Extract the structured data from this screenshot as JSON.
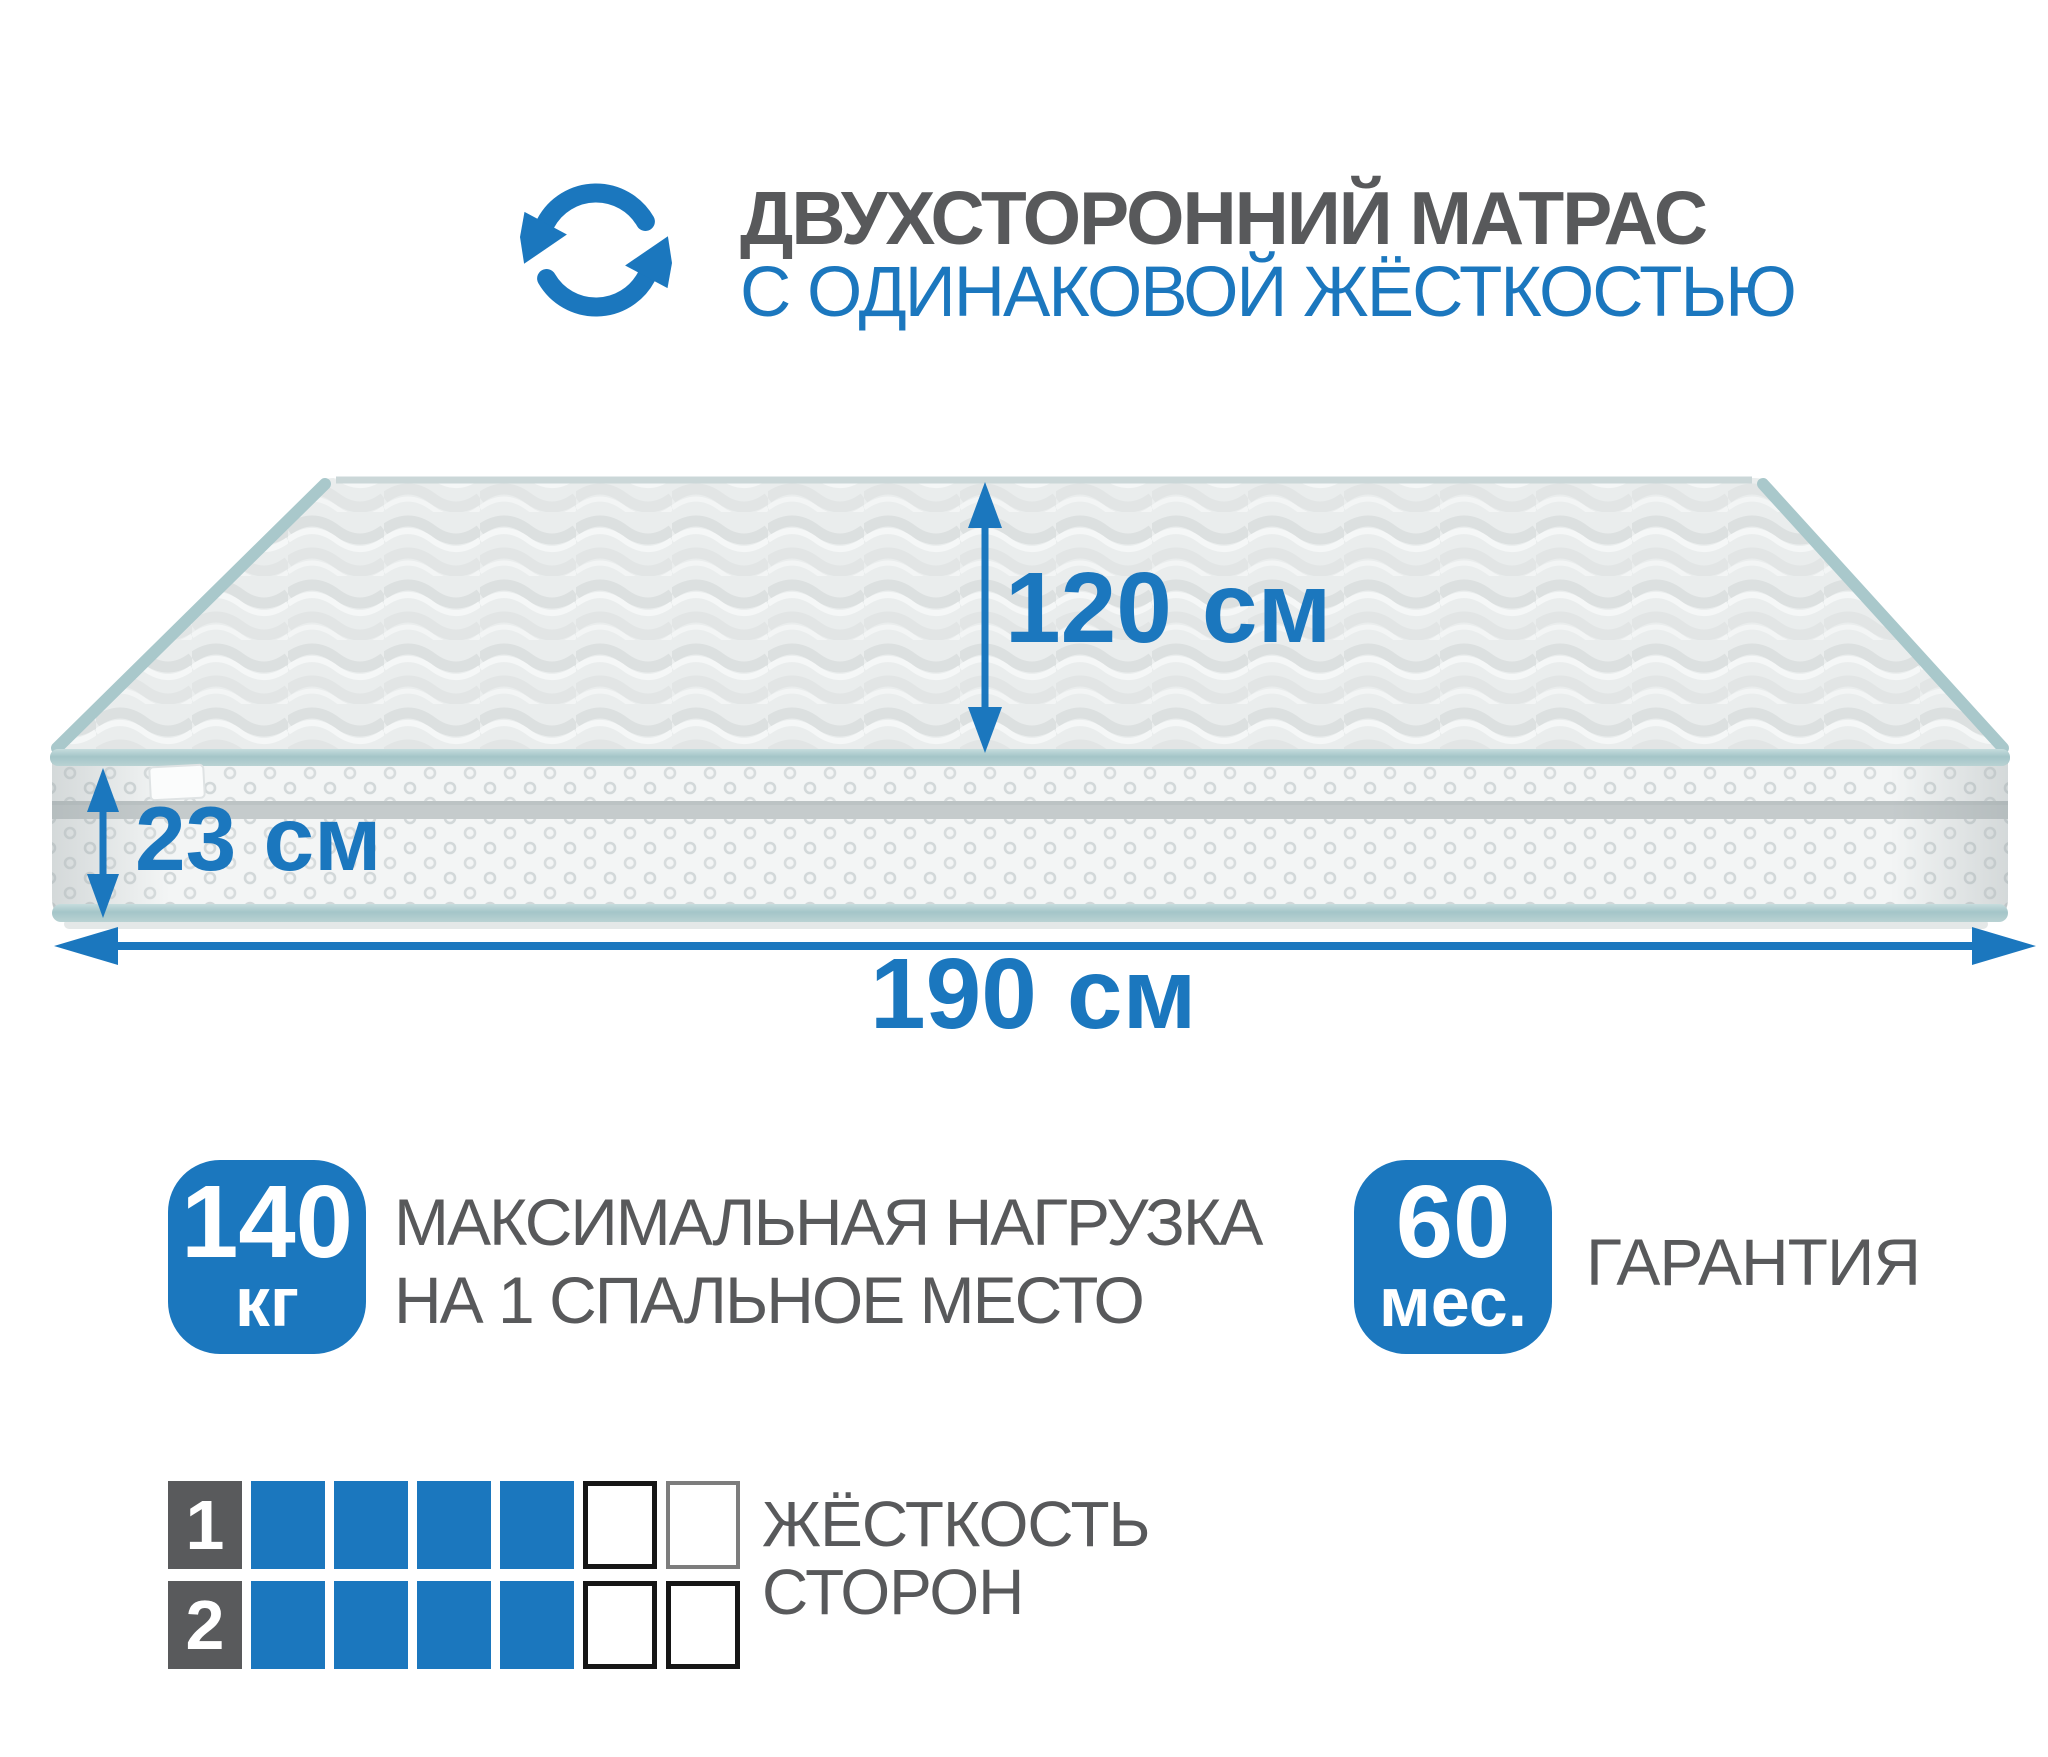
{
  "header": {
    "icon": "rotate-arrows-icon",
    "title": "ДВУХСТОРОННИЙ МАТРАС",
    "subtitle": "С ОДИНАКОВОЙ ЖЁСТКОСТЬЮ"
  },
  "dimensions": {
    "width": {
      "value": "120",
      "unit": "см"
    },
    "height": {
      "value": "23",
      "unit": "см"
    },
    "length": {
      "value": "190",
      "unit": "см"
    }
  },
  "features": {
    "max_load": {
      "value": "140",
      "unit": "кг",
      "description_line1": "МАКСИМАЛЬНАЯ НАГРУЗКА",
      "description_line2": "НА 1 СПАЛЬНОЕ МЕСТО"
    },
    "warranty": {
      "value": "60",
      "unit": "мес.",
      "label": "ГАРАНТИЯ"
    }
  },
  "firmness": {
    "label_line1": "ЖЁСТКОСТЬ",
    "label_line2": "СТОРОН",
    "scale_max": 6,
    "rows": [
      {
        "number": "1",
        "filled": 4,
        "cells": [
          "filled",
          "filled",
          "filled",
          "filled",
          "empty-dark",
          "empty-gray"
        ]
      },
      {
        "number": "2",
        "filled": 4,
        "cells": [
          "filled",
          "filled",
          "filled",
          "filled",
          "empty-dark",
          "empty-dark"
        ]
      }
    ]
  },
  "colors": {
    "accent_blue": "#1B77BE",
    "text_gray": "#58595B",
    "firmness_number_bg": "#595A5C"
  }
}
